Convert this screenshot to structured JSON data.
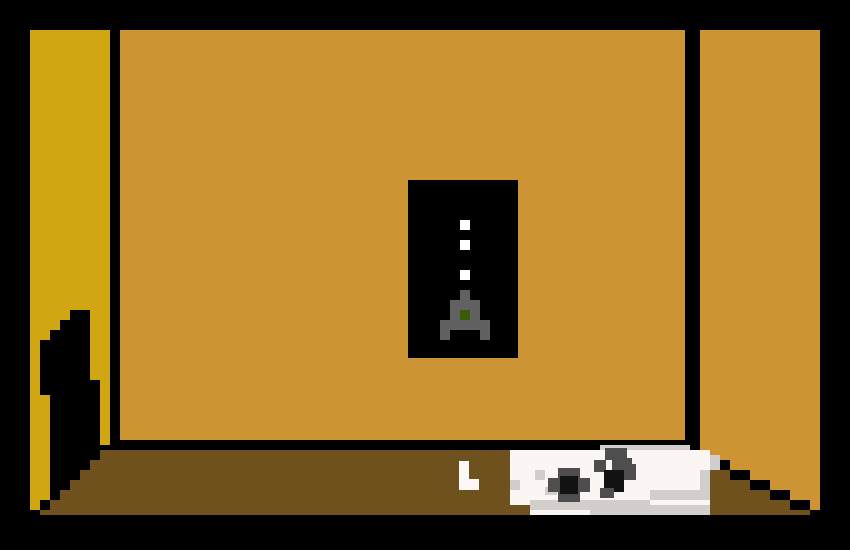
{
  "scene": {
    "name": "pixel-room",
    "description": "First-person pixel-art game room: mustard left wall, tan back and right walls, brown floor, dark doorway shadow at left, black wall poster of a grey rocket with dotted flight path, newspaper and chalk piece lying on the floor."
  },
  "colors": {
    "frame": "#000000",
    "left_wall": "#D0A613",
    "back_wall": "#CD9434",
    "right_wall": "#CD9434",
    "floor": "#6E511D",
    "poster_bg": "#000000",
    "poster_dot": "#FFFFFF",
    "rocket_body": "#616161",
    "rocket_window": "#3B5C07",
    "paper_white": "#FBF6F3",
    "paper_shade": "#D1CECC",
    "print_dark": "#4E4E4E",
    "print_black": "#121212",
    "chalk": "#FCF8F6"
  },
  "objects": [
    {
      "id": "left-wall",
      "label": "left wall"
    },
    {
      "id": "back-wall",
      "label": "back wall"
    },
    {
      "id": "right-wall",
      "label": "right wall"
    },
    {
      "id": "floor",
      "label": "floor"
    },
    {
      "id": "doorway-shadow",
      "label": "dark doorway shadow"
    },
    {
      "id": "rocket-poster",
      "label": "rocket poster"
    },
    {
      "id": "newspaper",
      "label": "newspaper"
    },
    {
      "id": "chalk",
      "label": "chalk piece"
    }
  ]
}
